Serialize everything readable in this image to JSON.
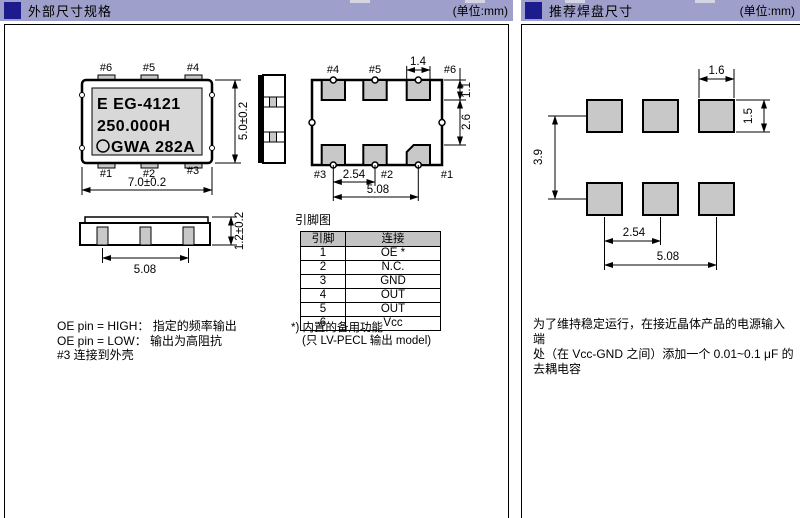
{
  "page": {
    "left_panel": {
      "header": {
        "title": "外部尺寸规格",
        "unit": "(单位:mm)"
      },
      "top_view": {
        "pin_labels_top": [
          "#6",
          "#5",
          "#4"
        ],
        "pin_labels_bottom": [
          "#1",
          "#2",
          "#3"
        ],
        "marking_line1": "E EG-4121",
        "marking_line2": "250.000H",
        "marking_line3": "GWA 282A",
        "dim_width": "7.0±0.2",
        "dim_height": "5.0±0.2"
      },
      "side_view": {
        "dim_span": "5.08",
        "dim_height": "1.2±0.2"
      },
      "bottom_view": {
        "pin_labels_top": [
          "#4",
          "#5",
          "#6"
        ],
        "pin_labels_bottom": [
          "#3",
          "#2",
          "#1"
        ],
        "dim_pad_width": "1.4",
        "dim_pad_height": "1.1",
        "dim_row_gap": "2.6",
        "dim_pitch": "2.54",
        "dim_span": "5.08"
      },
      "pin_table": {
        "title": "引脚图",
        "col_pin": "引脚",
        "col_conn": "连接",
        "rows": [
          {
            "pin": "1",
            "conn": "OE *"
          },
          {
            "pin": "2",
            "conn": "N.C."
          },
          {
            "pin": "3",
            "conn": "GND"
          },
          {
            "pin": "4",
            "conn": "OUT"
          },
          {
            "pin": "5",
            "conn": "OUT",
            "overline": true
          },
          {
            "pin": "6",
            "conn": "Vcc"
          }
        ],
        "footnote_line1": "*) 内置的备用功能",
        "footnote_line2": "(只 LV-PECL 输出 model)"
      },
      "notes": {
        "line1": "OE pin = HIGH： 指定的频率输出",
        "line2": "OE pin = LOW： 输出为高阻抗",
        "line3": "#3 连接到外壳"
      }
    },
    "right_panel": {
      "header": {
        "title": "推荐焊盘尺寸",
        "unit": "(单位:mm)"
      },
      "pad_layout": {
        "dim_pad_width": "1.6",
        "dim_pad_height": "1.5",
        "dim_row_pitch": "3.9",
        "dim_pitch": "2.54",
        "dim_span": "5.08"
      },
      "note": {
        "line1": "为了维持稳定运行，在接近晶体产品的电源输入端",
        "line2": "处（在 Vcc-GND 之间）添加一个 0.01~0.1 μF 的",
        "line3": "去耦电容"
      }
    },
    "colors": {
      "header_bar": "#9e9fca",
      "header_square": "#1c1c8c",
      "chip_fill": "#d8d8d8",
      "pad_fill": "#c8c8c8",
      "table_header_bg": "#c3c3c3"
    }
  }
}
